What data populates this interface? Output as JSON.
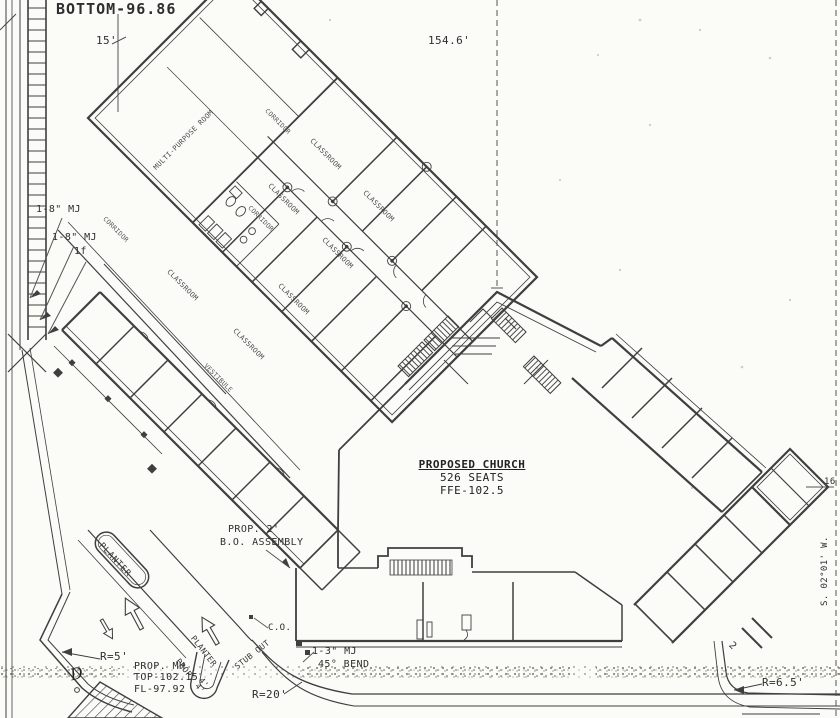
{
  "drawing": {
    "type": "scanned site plan",
    "colors": {
      "paper": "#fbfbf8",
      "ink": "#3f3f3f",
      "ink_light": "#8a8a8a",
      "stipple": "#aaa69c"
    }
  },
  "dimensions": {
    "bottom_elev": "BOTTOM-96.86",
    "dim_15": "15'",
    "dim_154": "154.6'",
    "dim_4": "4'",
    "num_2": "2",
    "num_16": "16",
    "bearing": "S. 02°01' W."
  },
  "utility_notes": {
    "mj8_a": "1-8\" MJ",
    "mj8_b": "1-8\" MJ",
    "fitting": "1f",
    "bo_line1": "PROP. 2'",
    "bo_line2": "B.O. ASSEMBLY",
    "mj3": "1-3\" MJ",
    "bend": "45° BEND",
    "cleanout": "C.O.",
    "mh_line1": "PROP. MH",
    "mh_line2": "TOP-102.15",
    "mh_line3": "FL-97.92",
    "prop4": "PROP. 4'",
    "stub_out": "STUB OUT",
    "symbol_d": "D"
  },
  "curves": {
    "r5": "R=5'",
    "r20": "R=20'",
    "r65": "R=6.5'"
  },
  "site": {
    "planter": "PLANTER",
    "planter2": "PLANTER"
  },
  "church": {
    "title": "PROPOSED CHURCH",
    "seats": "526 SEATS",
    "ffe": "FFE-102.5"
  },
  "rooms": {
    "multi_purpose": "MULTI-PURPOSE ROOM",
    "classroom": "CLASSROOM",
    "corridor": "CORRIDOR",
    "vestibule": "VESTIBULE"
  }
}
